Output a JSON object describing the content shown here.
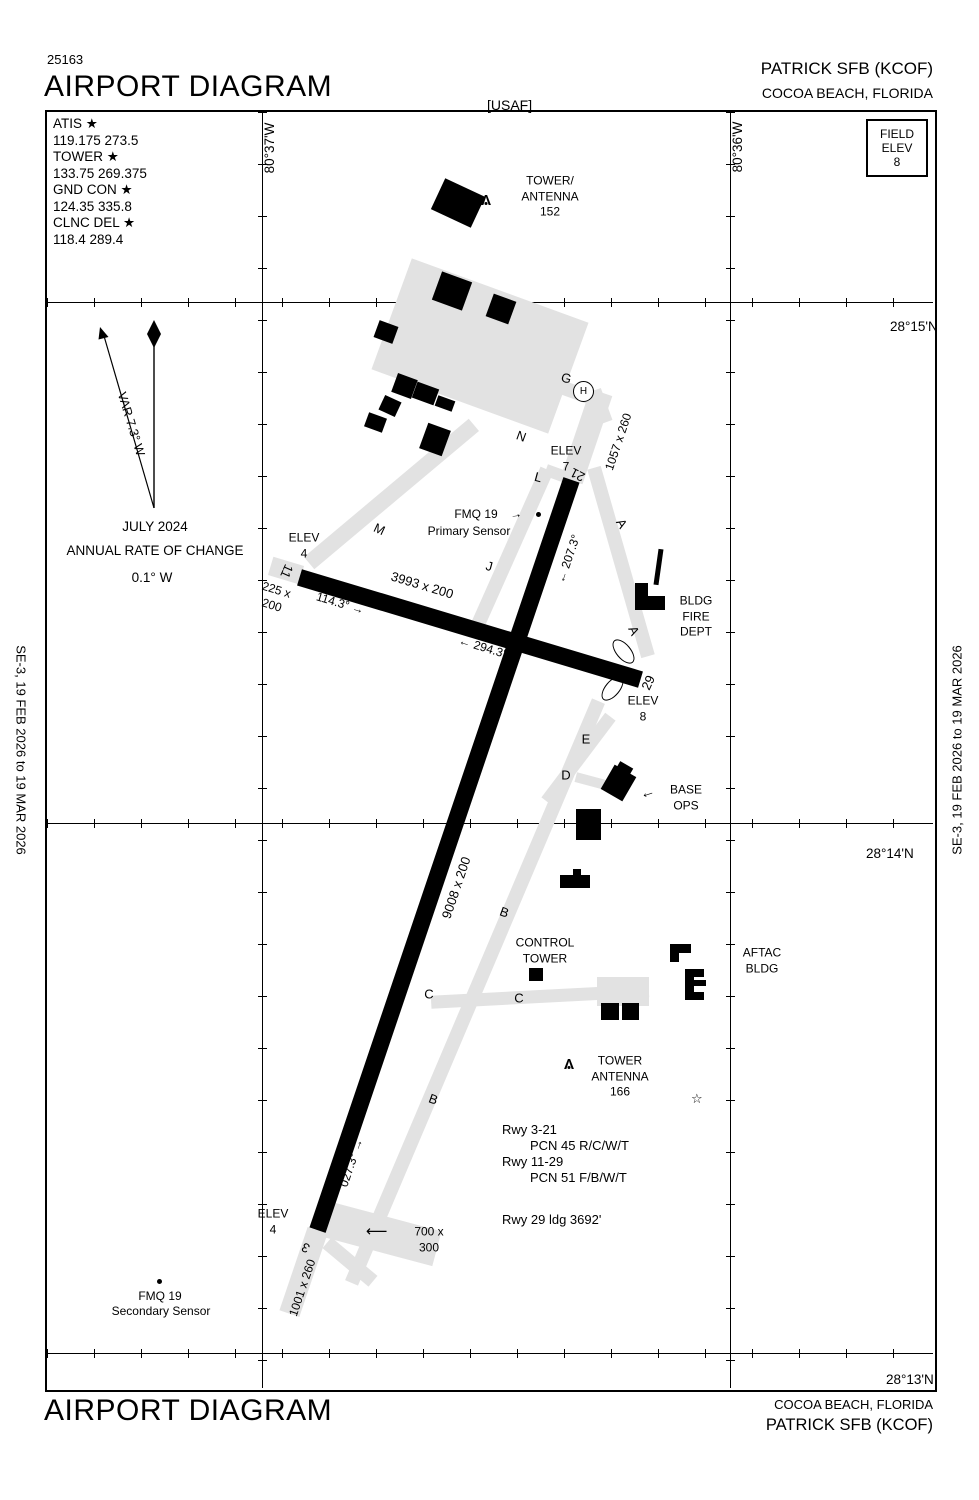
{
  "header": {
    "chart_number": "25163",
    "title": "AIRPORT DIAGRAM",
    "operator": "[USAF]",
    "airport": "PATRICK SFB  (KCOF)",
    "city": "COCOA BEACH, FLORIDA"
  },
  "field_elev": {
    "l1": "FIELD",
    "l2": "ELEV",
    "value": "8"
  },
  "frequencies": [
    {
      "label": "ATIS ★",
      "value": "119.175  273.5"
    },
    {
      "label": "TOWER ★",
      "value": "133.75  269.375"
    },
    {
      "label": "GND CON ★",
      "value": "124.35  335.8"
    },
    {
      "label": "CLNC DEL ★",
      "value": "118.4  289.4"
    }
  ],
  "compass": {
    "var": "VAR 7.3° W",
    "date": "JULY 2024",
    "rate": "ANNUAL RATE OF CHANGE",
    "value": "0.1° W"
  },
  "grid": {
    "lat15": "28°15'N",
    "lat14": "28°14'N",
    "lat13": "28°13'N",
    "lon37": "80°37'W",
    "lon36": "80°36'W"
  },
  "margin": {
    "left": "SE-3,  19 FEB 2026  to  19 MAR 2026",
    "right": "SE-3,  19 FEB 2026  to  19 MAR 2026"
  },
  "map": {
    "tower152": {
      "l1": "TOWER/",
      "l2": "ANTENNA",
      "l3": "152"
    },
    "helipad": "H",
    "tw": {
      "g": "G",
      "n": "N",
      "m": "M",
      "l": "L",
      "j": "J",
      "a": "A",
      "e": "E",
      "d": "D",
      "b": "B",
      "c": "C"
    },
    "elev7": {
      "label": "ELEV",
      "value": "7"
    },
    "elev4": {
      "label": "ELEV",
      "value": "4"
    },
    "elev8": {
      "label": "ELEV",
      "value": "8"
    },
    "rwy11_29": {
      "dims": "3993 x 200",
      "hdg_e": "114.3°",
      "hdg_w": "294.3°",
      "num_w": "11",
      "num_e": "29",
      "stopway1": "225 x",
      "stopway2": "200"
    },
    "rwy3_21": {
      "dims": "9008 x 200",
      "hdg_ne": "027.3°",
      "hdg_sw": "207.3°",
      "num_n": "21",
      "num_s": "3",
      "overrun_n": "1057 x 260",
      "overrun_s": "1001 x 260"
    },
    "pad700": {
      "l1": "700 x",
      "l2": "300"
    },
    "fmq_primary": {
      "l1": "FMQ 19",
      "l2": "Primary Sensor"
    },
    "fmq_secondary": {
      "l1": "FMQ 19",
      "l2": "Secondary Sensor"
    },
    "fire_dept": {
      "l1": "BLDG",
      "l2": "FIRE",
      "l3": "DEPT"
    },
    "base_ops": {
      "l1": "BASE",
      "l2": "OPS"
    },
    "control_tower": {
      "l1": "CONTROL",
      "l2": "TOWER"
    },
    "aftac": {
      "l1": "AFTAC",
      "l2": "BLDG"
    },
    "tower166": {
      "l1": "TOWER",
      "l2": "ANTENNA",
      "l3": "166"
    },
    "rwy_data": {
      "l1": "Rwy 3-21",
      "l2": "PCN 45 R/C/W/T",
      "l3": "Rwy 11-29",
      "l4": "PCN 51 F/B/W/T",
      "ldg": "Rwy 29 ldg 3692'"
    }
  },
  "footer": {
    "title": "AIRPORT DIAGRAM",
    "city": "COCOA BEACH, FLORIDA",
    "airport": "PATRICK SFB  (KCOF)"
  }
}
